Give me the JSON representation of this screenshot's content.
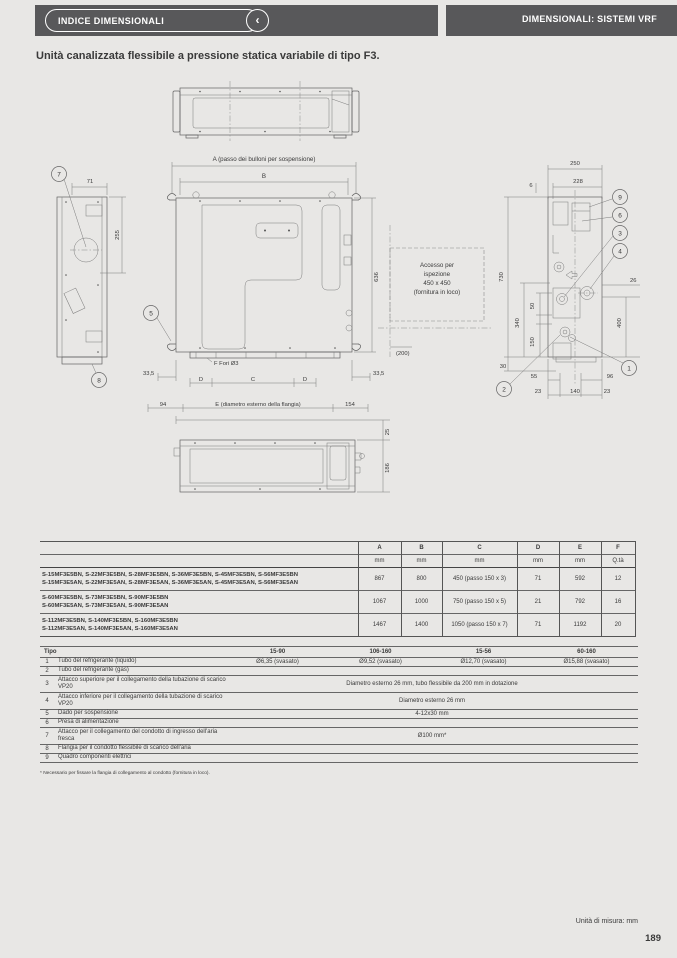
{
  "header": {
    "left_tab": "INDICE DIMENSIONALI",
    "chevron": "‹",
    "right_tab": "DIMENSIONALI: SISTEMI VRF"
  },
  "page": {
    "title": "Unità canalizzata flessibile a pressione statica variabile di tipo F3.",
    "footnote": "* Necessario per fissare la flangia di collegamento al condotto (fornitura in loco).",
    "units_note": "Unità di misura: mm",
    "page_number": "189"
  },
  "drawing": {
    "left_view": {
      "dim_width": "71",
      "dim_height": "255",
      "callout_top": "7",
      "callout_bottom": "8"
    },
    "plan_view": {
      "dim_a_label": "A (passo dei bulloni per sospensione)",
      "dim_b_label": "B",
      "callout_hanger": "5",
      "dim_335_left": "33,5",
      "dim_335_right": "33,5",
      "holes_label": "F Fori Ø3",
      "dim_d1": "D",
      "dim_c": "C",
      "dim_d2": "D",
      "dim_94": "94",
      "dim_e_label": "E (diametro esterno della flangia)",
      "dim_154": "154",
      "dim_height": "636",
      "dim_200": "(200)",
      "access_line1": "Accesso per",
      "access_line2": "ispezione",
      "access_line3": "450 x 450",
      "access_line4": "(fornitura in loco)"
    },
    "right_view": {
      "dim_250": "250",
      "dim_228": "228",
      "dim_6": "6",
      "dim_730": "730",
      "dim_340": "340",
      "dim_150": "150",
      "dim_50": "50",
      "dim_30": "30",
      "dim_26": "26",
      "dim_400": "400",
      "dim_55": "55",
      "dim_96": "96",
      "dim_23a": "23",
      "dim_140": "140",
      "dim_23b": "23",
      "callout_9": "9",
      "callout_6": "6",
      "callout_3": "3",
      "callout_4": "4",
      "callout_1": "1",
      "callout_2": "2"
    },
    "bottom_view": {
      "dim_25": "25",
      "dim_186": "186"
    }
  },
  "table1": {
    "headers": [
      "A",
      "B",
      "C",
      "D",
      "E",
      "F"
    ],
    "units": [
      "mm",
      "mm",
      "mm",
      "mm",
      "mm",
      "Q.tà"
    ],
    "rows": [
      {
        "models_line1": "S-15MF3E5BN, S-22MF3E5BN, S-28MF3E5BN, S-36MF3E5BN, S-45MF3E5BN, S-56MF3E5BN",
        "models_line2": "S-15MF3E5AN, S-22MF3E5AN, S-28MF3E5AN, S-36MF3E5AN, S-45MF3E5AN, S-56MF3E5AN",
        "a": "867",
        "b": "800",
        "c": "450 (passo 150 x 3)",
        "d": "71",
        "e": "592",
        "f": "12"
      },
      {
        "models_line1": "S-60MF3E5BN, S-73MF3E5BN, S-90MF3E5BN",
        "models_line2": "S-60MF3E5AN, S-73MF3E5AN, S-90MF3E5AN",
        "a": "1067",
        "b": "1000",
        "c": "750 (passo 150 x 5)",
        "d": "21",
        "e": "792",
        "f": "16"
      },
      {
        "models_line1": "S-112MF3E5BN, S-140MF3E5BN, S-160MF3E5BN",
        "models_line2": "S-112MF3E5AN, S-140MF3E5AN, S-160MF3E5AN",
        "a": "1467",
        "b": "1400",
        "c": "1050 (passo 150 x 7)",
        "d": "71",
        "e": "1192",
        "f": "20"
      }
    ]
  },
  "table2": {
    "type_header": "Tipo",
    "col_headers": [
      "15-90",
      "106-160",
      "15-56",
      "60-160"
    ],
    "rows": [
      {
        "num": "1",
        "label": "Tubo del refrigerante (liquido)",
        "v0": "Ø6,35 (svasato)",
        "v1": "Ø9,52 (svasato)",
        "v2": "Ø12,70 (svasato)",
        "v3": "Ø15,88 (svasato)"
      },
      {
        "num": "2",
        "label": "Tubo del refrigerante (gas)",
        "span": ""
      },
      {
        "num": "3",
        "label": "Attacco superiore per il collegamento della tubazione di scarico VP20",
        "span": "Diametro esterno 26 mm, tubo flessibile da 200 mm in dotazione"
      },
      {
        "num": "4",
        "label": "Attacco inferiore per il collegamento della tubazione di scarico VP20",
        "span": "Diametro esterno 26 mm"
      },
      {
        "num": "5",
        "label": "Dado per sospensione",
        "span": "4-12x30 mm"
      },
      {
        "num": "6",
        "label": "Presa di alimentazione",
        "span": ""
      },
      {
        "num": "7",
        "label": "Attacco per il collegamento del condotto di ingresso dell'aria fresca",
        "span": "Ø100 mm*"
      },
      {
        "num": "8",
        "label": "Flangia per il condotto flessibile di scarico dell'aria",
        "span": ""
      },
      {
        "num": "9",
        "label": "Quadro componenti elettrici",
        "span": ""
      }
    ]
  }
}
